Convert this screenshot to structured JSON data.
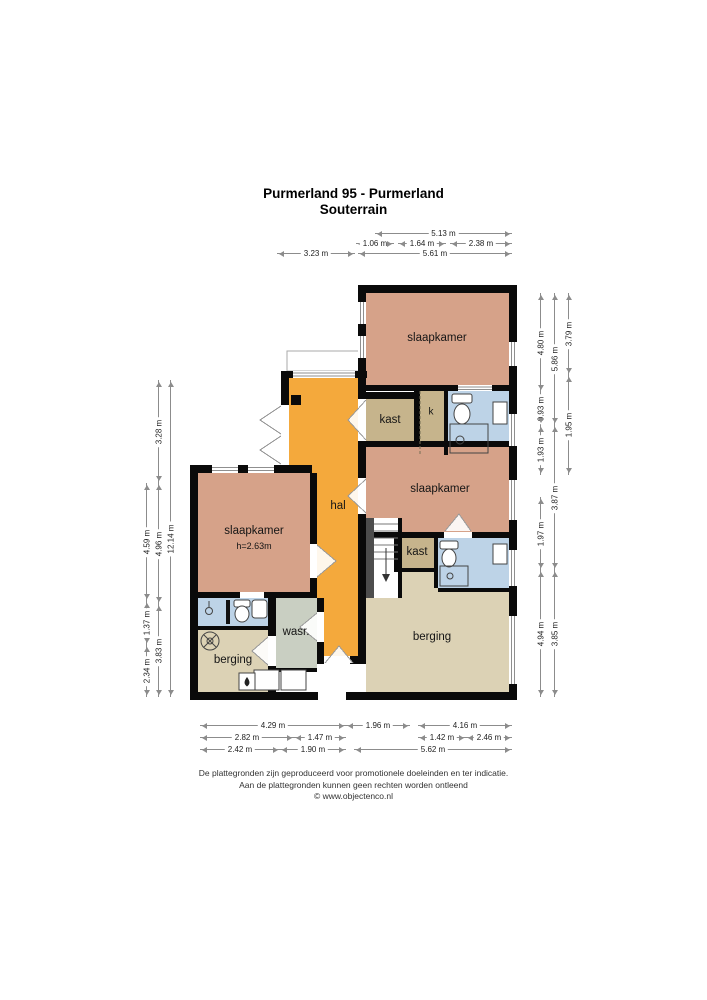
{
  "title": {
    "line1": "Purmerland 95 - Purmerland",
    "line2": "Souterrain"
  },
  "rooms": {
    "slaapkamer_top": {
      "label": "slaapkamer"
    },
    "slaapkamer_right": {
      "label": "slaapkamer"
    },
    "slaapkamer_left": {
      "label": "slaapkamer",
      "height_note": "h=2.63m"
    },
    "hal": {
      "label": "hal"
    },
    "kast_top": {
      "label": "kast"
    },
    "kast_right": {
      "label": "kast"
    },
    "k_closet": {
      "label": "k"
    },
    "wasruimte": {
      "label": "wasr."
    },
    "berging_left": {
      "label": "berging"
    },
    "berging_right": {
      "label": "berging"
    }
  },
  "dimensions": {
    "top": [
      "5.13 m",
      "1.06 m",
      "1.64 m",
      "2.38 m",
      "3.23 m",
      "5.61 m"
    ],
    "bottom": [
      "4.29 m",
      "1.96 m",
      "4.16 m",
      "2.82 m",
      "1.47 m",
      "1.42 m",
      "2.46 m",
      "2.42 m",
      "1.90 m",
      "5.62 m"
    ],
    "left": [
      "4.59 m",
      "1.37 m",
      "2.34 m",
      "3.28 m",
      "4.96 m",
      "3.83 m",
      "12.14 m"
    ],
    "right": [
      "4.80 m",
      "0.93 m",
      "1.93 m",
      "1.97 m",
      "4.94 m",
      "5.86 m",
      "3.87 m",
      "3.85 m",
      "3.79 m",
      "1.95 m"
    ]
  },
  "footer": {
    "line1": "De plattegronden zijn geproduceerd voor promotionele doeleinden en ter indicatie.",
    "line2": "Aan de plattegronden kunnen geen rechten worden ontleend",
    "line3": "© www.objectenco.nl"
  },
  "colors": {
    "bedroom": "#d6a289",
    "hall": "#f4a93c",
    "closet": "#c6b48c",
    "bathroom": "#bdd3e7",
    "storage": "#dcd2b5",
    "laundry": "#c9cfc2",
    "stairs_side": "#4d4d4d",
    "wall": "#0a0a0a"
  },
  "icons": {
    "stairs_direction": "down-arrow",
    "boiler": "flame-box",
    "ventilation": "fan-circle"
  }
}
